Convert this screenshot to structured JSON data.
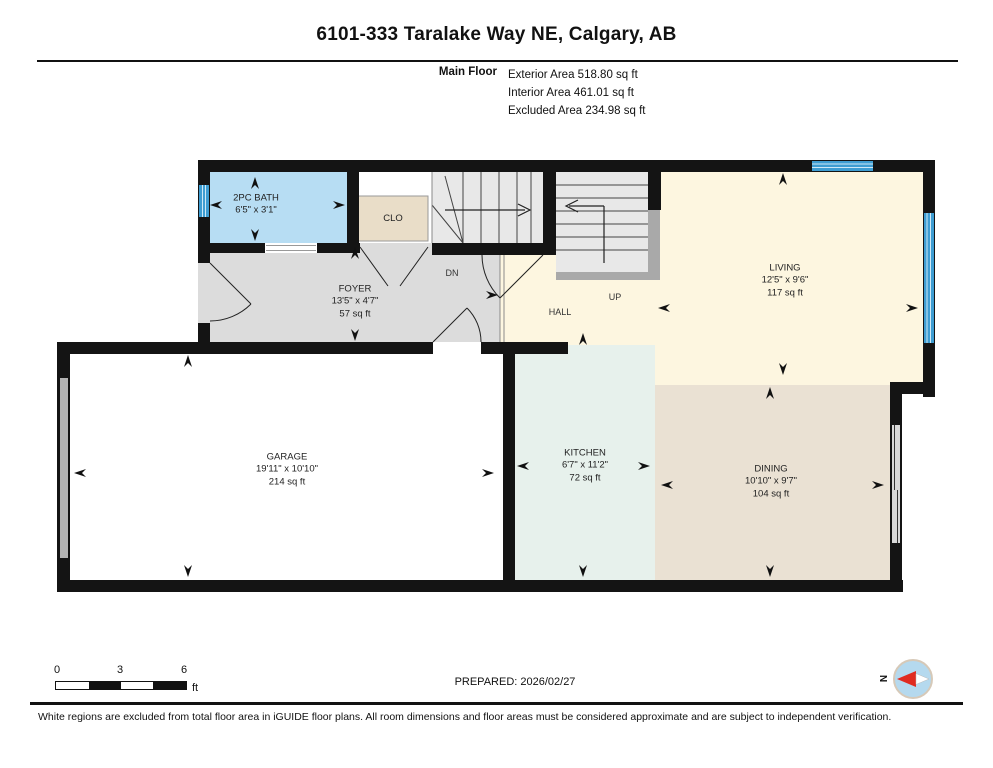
{
  "header": {
    "title": "6101-333 Taralake Way NE, Calgary, AB",
    "floor_label": "Main Floor",
    "area_lines": [
      "Exterior Area 518.80 sq ft",
      "Interior Area 461.01 sq ft",
      "Excluded Area 234.98 sq ft"
    ]
  },
  "rooms": {
    "bath": {
      "name": "2PC BATH",
      "dims": "6'5\" x 3'1\""
    },
    "closet": {
      "name": "CLO"
    },
    "foyer": {
      "name": "FOYER",
      "dims": "13'5\" x 4'7\"",
      "area": "57 sq ft"
    },
    "hall": {
      "name": "HALL"
    },
    "living": {
      "name": "LIVING",
      "dims": "12'5\" x 9'6\"",
      "area": "117 sq ft"
    },
    "garage": {
      "name": "GARAGE",
      "dims": "19'11\" x 10'10\"",
      "area": "214 sq ft"
    },
    "kitchen": {
      "name": "KITCHEN",
      "dims": "6'7\" x 11'2\"",
      "area": "72 sq ft"
    },
    "dining": {
      "name": "DINING",
      "dims": "10'10\" x 9'7\"",
      "area": "104 sq ft"
    },
    "stairs_down_label": "DN",
    "stairs_up_label": "UP"
  },
  "scale_bar": {
    "tick_0": "0",
    "tick_3": "3",
    "tick_6": "6",
    "unit": "ft"
  },
  "prepared_label": "PREPARED: 2026/02/27",
  "compass": {
    "north_label": "N"
  },
  "footer_note": "White regions are excluded from total floor area in iGUIDE floor plans. All room dimensions and floor areas must be considered approximate and are subject to independent verification.",
  "colors": {
    "wall": "#141414",
    "window": "#3e9dd2",
    "bath": "#b7ddf3",
    "closet": "#e9ddc8",
    "foyer": "#dcdcdc",
    "stairs": "#e8e8e8",
    "hall_living": "#fdf6e0",
    "garage": "#ffffff",
    "kitchen": "#e7f1ec",
    "dining": "#eae1d3",
    "compass_needle": "#e02b20"
  }
}
